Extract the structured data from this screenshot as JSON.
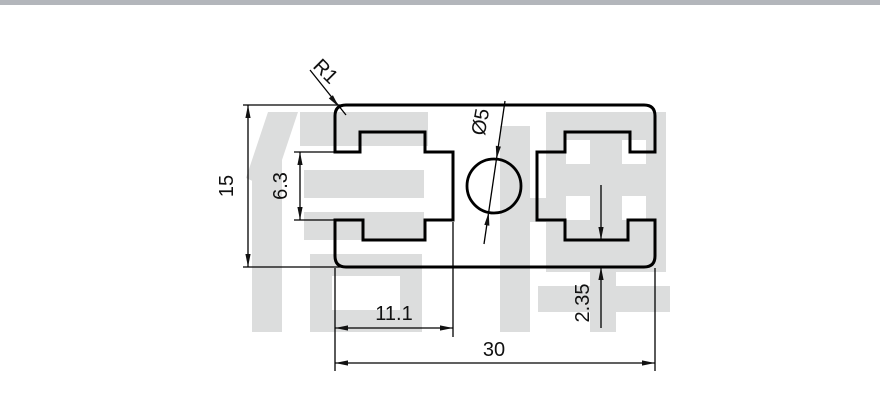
{
  "page": {
    "background": "#ffffff",
    "top_bar_color": "#b3b6bb"
  },
  "watermark": {
    "text": "信牌",
    "color": "#dcdddd"
  },
  "drawing": {
    "line_color": "#000000",
    "description_labels": {
      "overall_height": "15",
      "slot_opening": "6.3",
      "corner_radius": "R1",
      "hole_diameter": "Ø5",
      "slot_depth": "11.1",
      "overall_width": "30",
      "lip_thickness": "2.35"
    }
  }
}
